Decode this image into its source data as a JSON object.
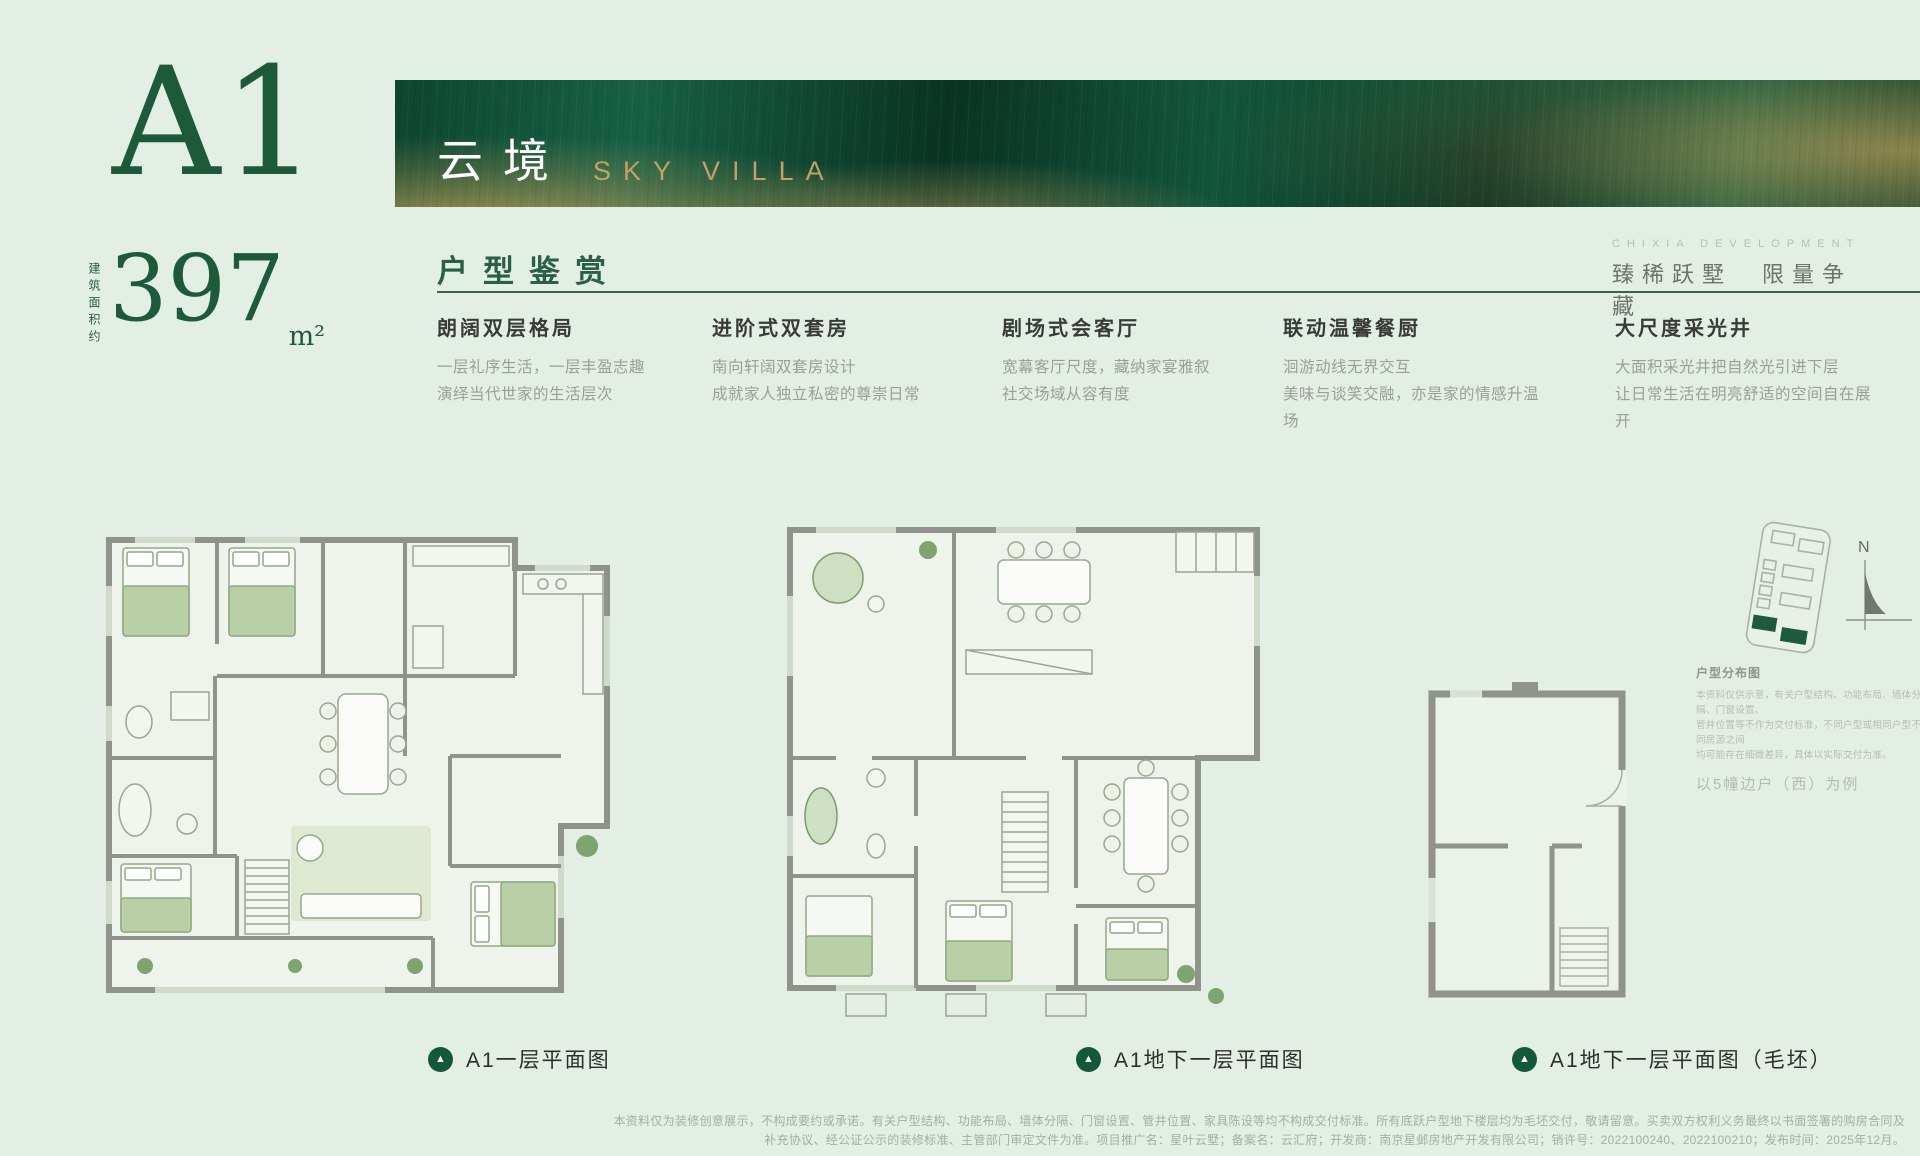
{
  "header": {
    "unit": "A1",
    "area_label": "建筑面积约",
    "area_value": "397",
    "area_unit": "m²"
  },
  "banner": {
    "title_cn": "云境",
    "title_en": "SKY VILLA"
  },
  "section": {
    "heading": "户型鉴赏",
    "developer_en": "CHIXIA DEVELOPMENT",
    "tagline_cn": "臻稀跃墅　限量争藏"
  },
  "features": [
    {
      "title": "朗阔双层格局",
      "line1": "一层礼序生活，一层丰盈志趣",
      "line2": "演绎当代世家的生活层次"
    },
    {
      "title": "进阶式双套房",
      "line1": "南向轩阔双套房设计",
      "line2": "成就家人独立私密的尊崇日常"
    },
    {
      "title": "剧场式会客厅",
      "line1": "宽幕客厅尺度，藏纳家宴雅叙",
      "line2": "社交场域从容有度"
    },
    {
      "title": "联动温馨餐厨",
      "line1": "洄游动线无界交互",
      "line2": "美味与谈笑交融，亦是家的情感升温场"
    },
    {
      "title": "大尺度采光井",
      "line1": "大面积采光井把自然光引进下层",
      "line2": "让日常生活在明亮舒适的空间自在展开"
    }
  ],
  "plans": [
    {
      "caption": "A1一层平面图"
    },
    {
      "caption": "A1地下一层平面图"
    },
    {
      "caption": "A1地下一层平面图（毛坯）"
    }
  ],
  "icons": {
    "plan_marker": "▲"
  },
  "sitemap": {
    "north": "N",
    "title": "户型分布图",
    "note1": "本资料仅供示意，有关户型结构、功能布局、墙体分隔、门窗设置、",
    "note2": "管井位置等不作为交付标准，不同户型或相同户型不同房源之间",
    "note3": "均可能存在细微差异，具体以实际交付为准。",
    "example": "以5幢边户（西）为例"
  },
  "disclaimer": {
    "line1": "本资料仅为装修创意展示，不构成要约或承诺。有关户型结构、功能布局、墙体分隔、门窗设置、管井位置、家具陈设等均不构成交付标准。所有底跃户型地下楼层均为毛坯交付，敬请留意。买卖双方权利义务最终以书面签署的购房合同及",
    "line2": "补充协议、经公证公示的装修标准、主管部门审定文件为准。项目推广名：星叶云墅；备案名：云汇府；开发商：南京星邺房地产开发有限公司；销许号：2022100240、2022100210；发布时间：2025年12月。"
  },
  "colors": {
    "background": "#e3eee4",
    "brand_green": "#1d5a39",
    "banner_gold": "#c2a066",
    "text_dark": "#393b36",
    "text_gray": "#9aa096",
    "wall_gray": "#8f938c"
  }
}
